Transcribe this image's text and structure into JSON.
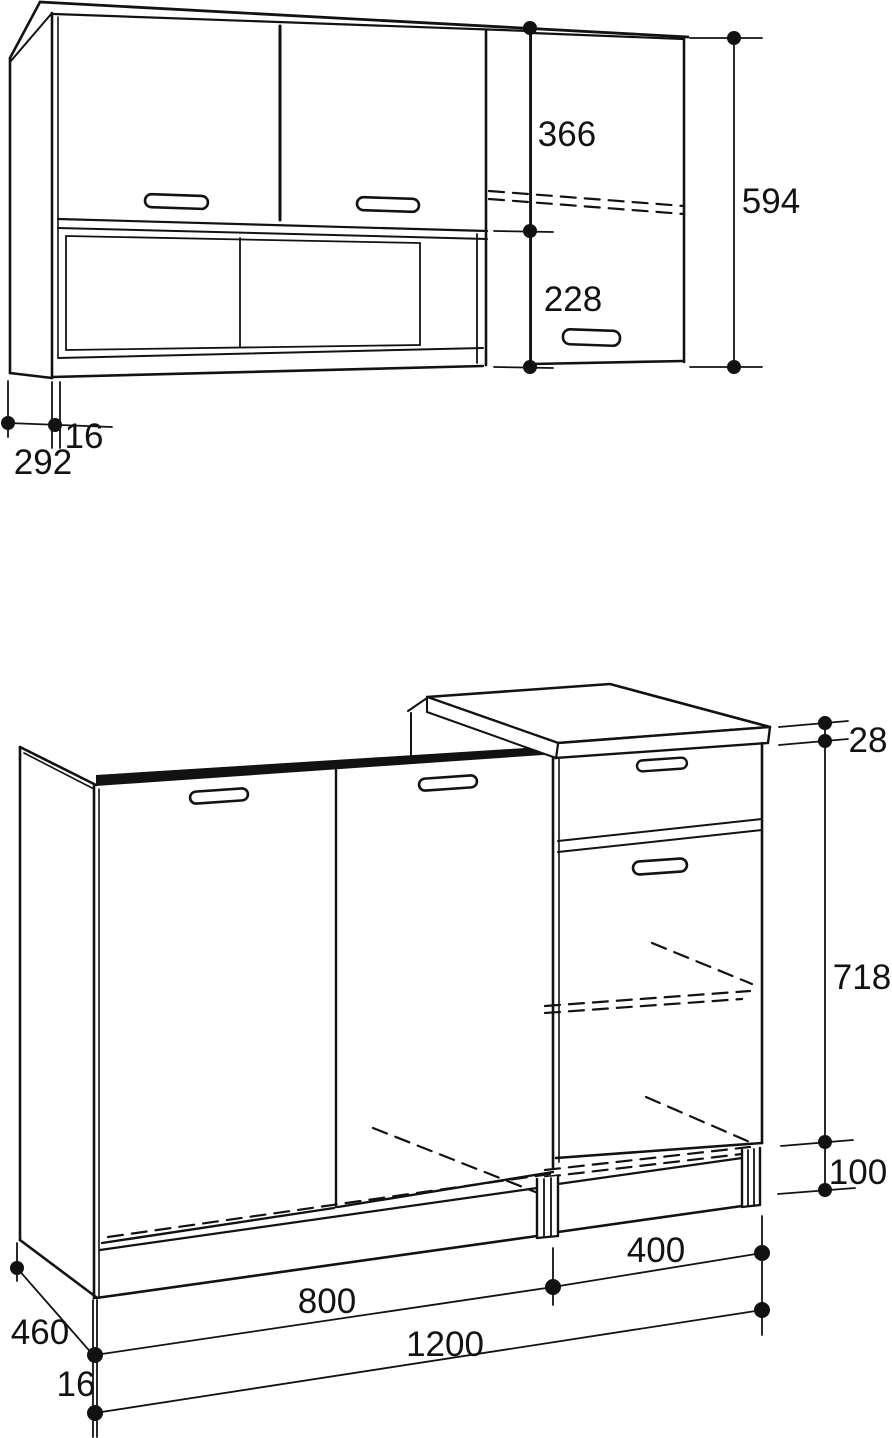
{
  "page": {
    "title": "Kitchen cabinet dimension drawing",
    "background_color": "#ffffff",
    "line_color": "#121212"
  },
  "wall_cabinet": {
    "description": "wall cabinet elevation with two doors, open shelf and tall right door",
    "dimensions": {
      "door_section_height": "366",
      "open_shelf_height": "228",
      "total_height": "594",
      "side_panel_thickness": "16",
      "depth": "292"
    }
  },
  "base_cabinet": {
    "description": "base cabinet perspective with two doors, right drawer unit and countertop",
    "dimensions": {
      "countertop_thickness": "28",
      "carcass_height": "718",
      "plinth_height": "100",
      "right_unit_width": "400",
      "left_unit_width": "800",
      "total_width": "1200",
      "depth": "460",
      "panel_thickness": "16"
    }
  }
}
